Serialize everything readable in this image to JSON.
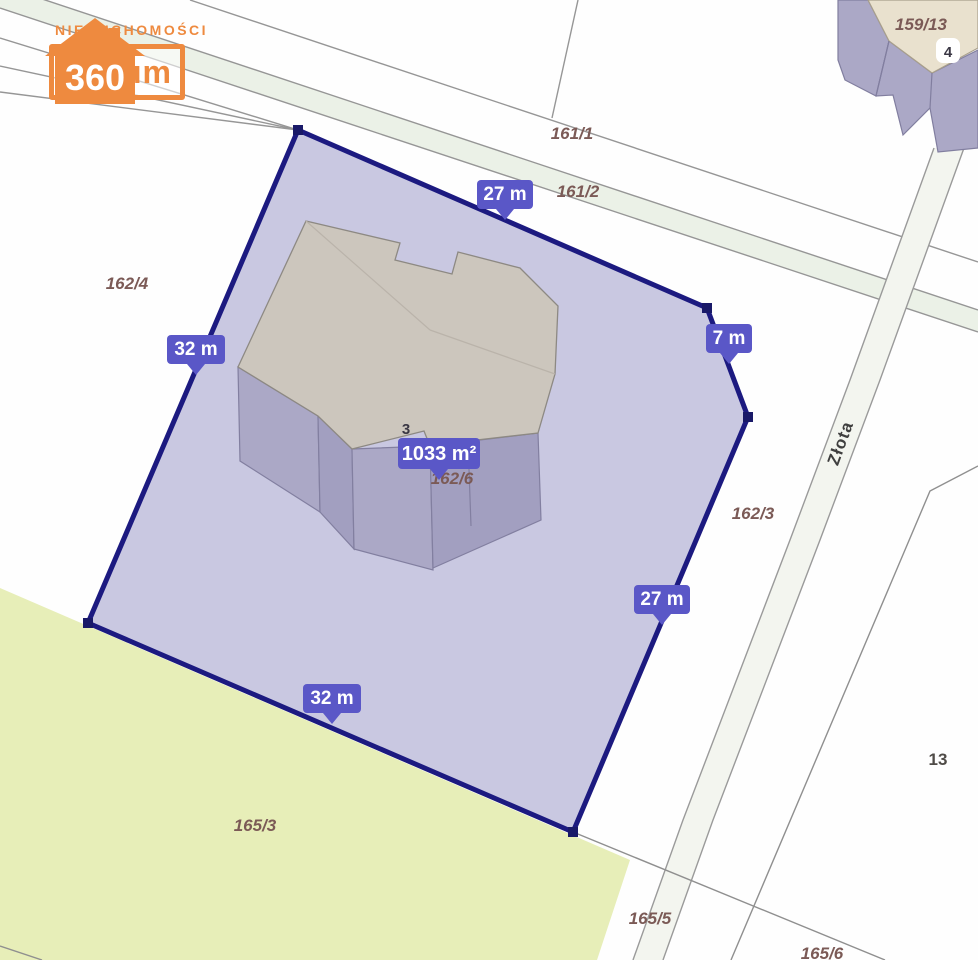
{
  "logo": {
    "tagline": "NIERUCHOMOŚCI",
    "name": "Lokum",
    "suffix": "360",
    "accent_color": "#ee8a3f"
  },
  "map": {
    "street": {
      "label": "Złota",
      "label_second": "Złota"
    },
    "parcels": [
      {
        "label": "161/1"
      },
      {
        "label": "161/2"
      },
      {
        "label": "162/4"
      },
      {
        "label": "162/6"
      },
      {
        "label": "162/3"
      },
      {
        "label": "159/13"
      },
      {
        "label": "165/3"
      },
      {
        "label": "165/5"
      },
      {
        "label": "165/6"
      },
      {
        "label": "13"
      }
    ],
    "buildings": {
      "main_number": "3",
      "neighbor_number": "4"
    },
    "measurements": {
      "top": "27 m",
      "left": "32 m",
      "right_short": "7 m",
      "right": "27 m",
      "bottom": "32 m",
      "area": "1033 m²"
    },
    "colors": {
      "plot_fill": "#c9c8e1",
      "plot_border": "#1c1a80",
      "tooltip": "#5a57c7",
      "olive_parcel": "#e7eeb8",
      "road_line": "#969696",
      "building_wall": "#aba8c6",
      "building_roof": "#ccc6bd",
      "neighbor_roof": "#e9e1ce"
    }
  }
}
